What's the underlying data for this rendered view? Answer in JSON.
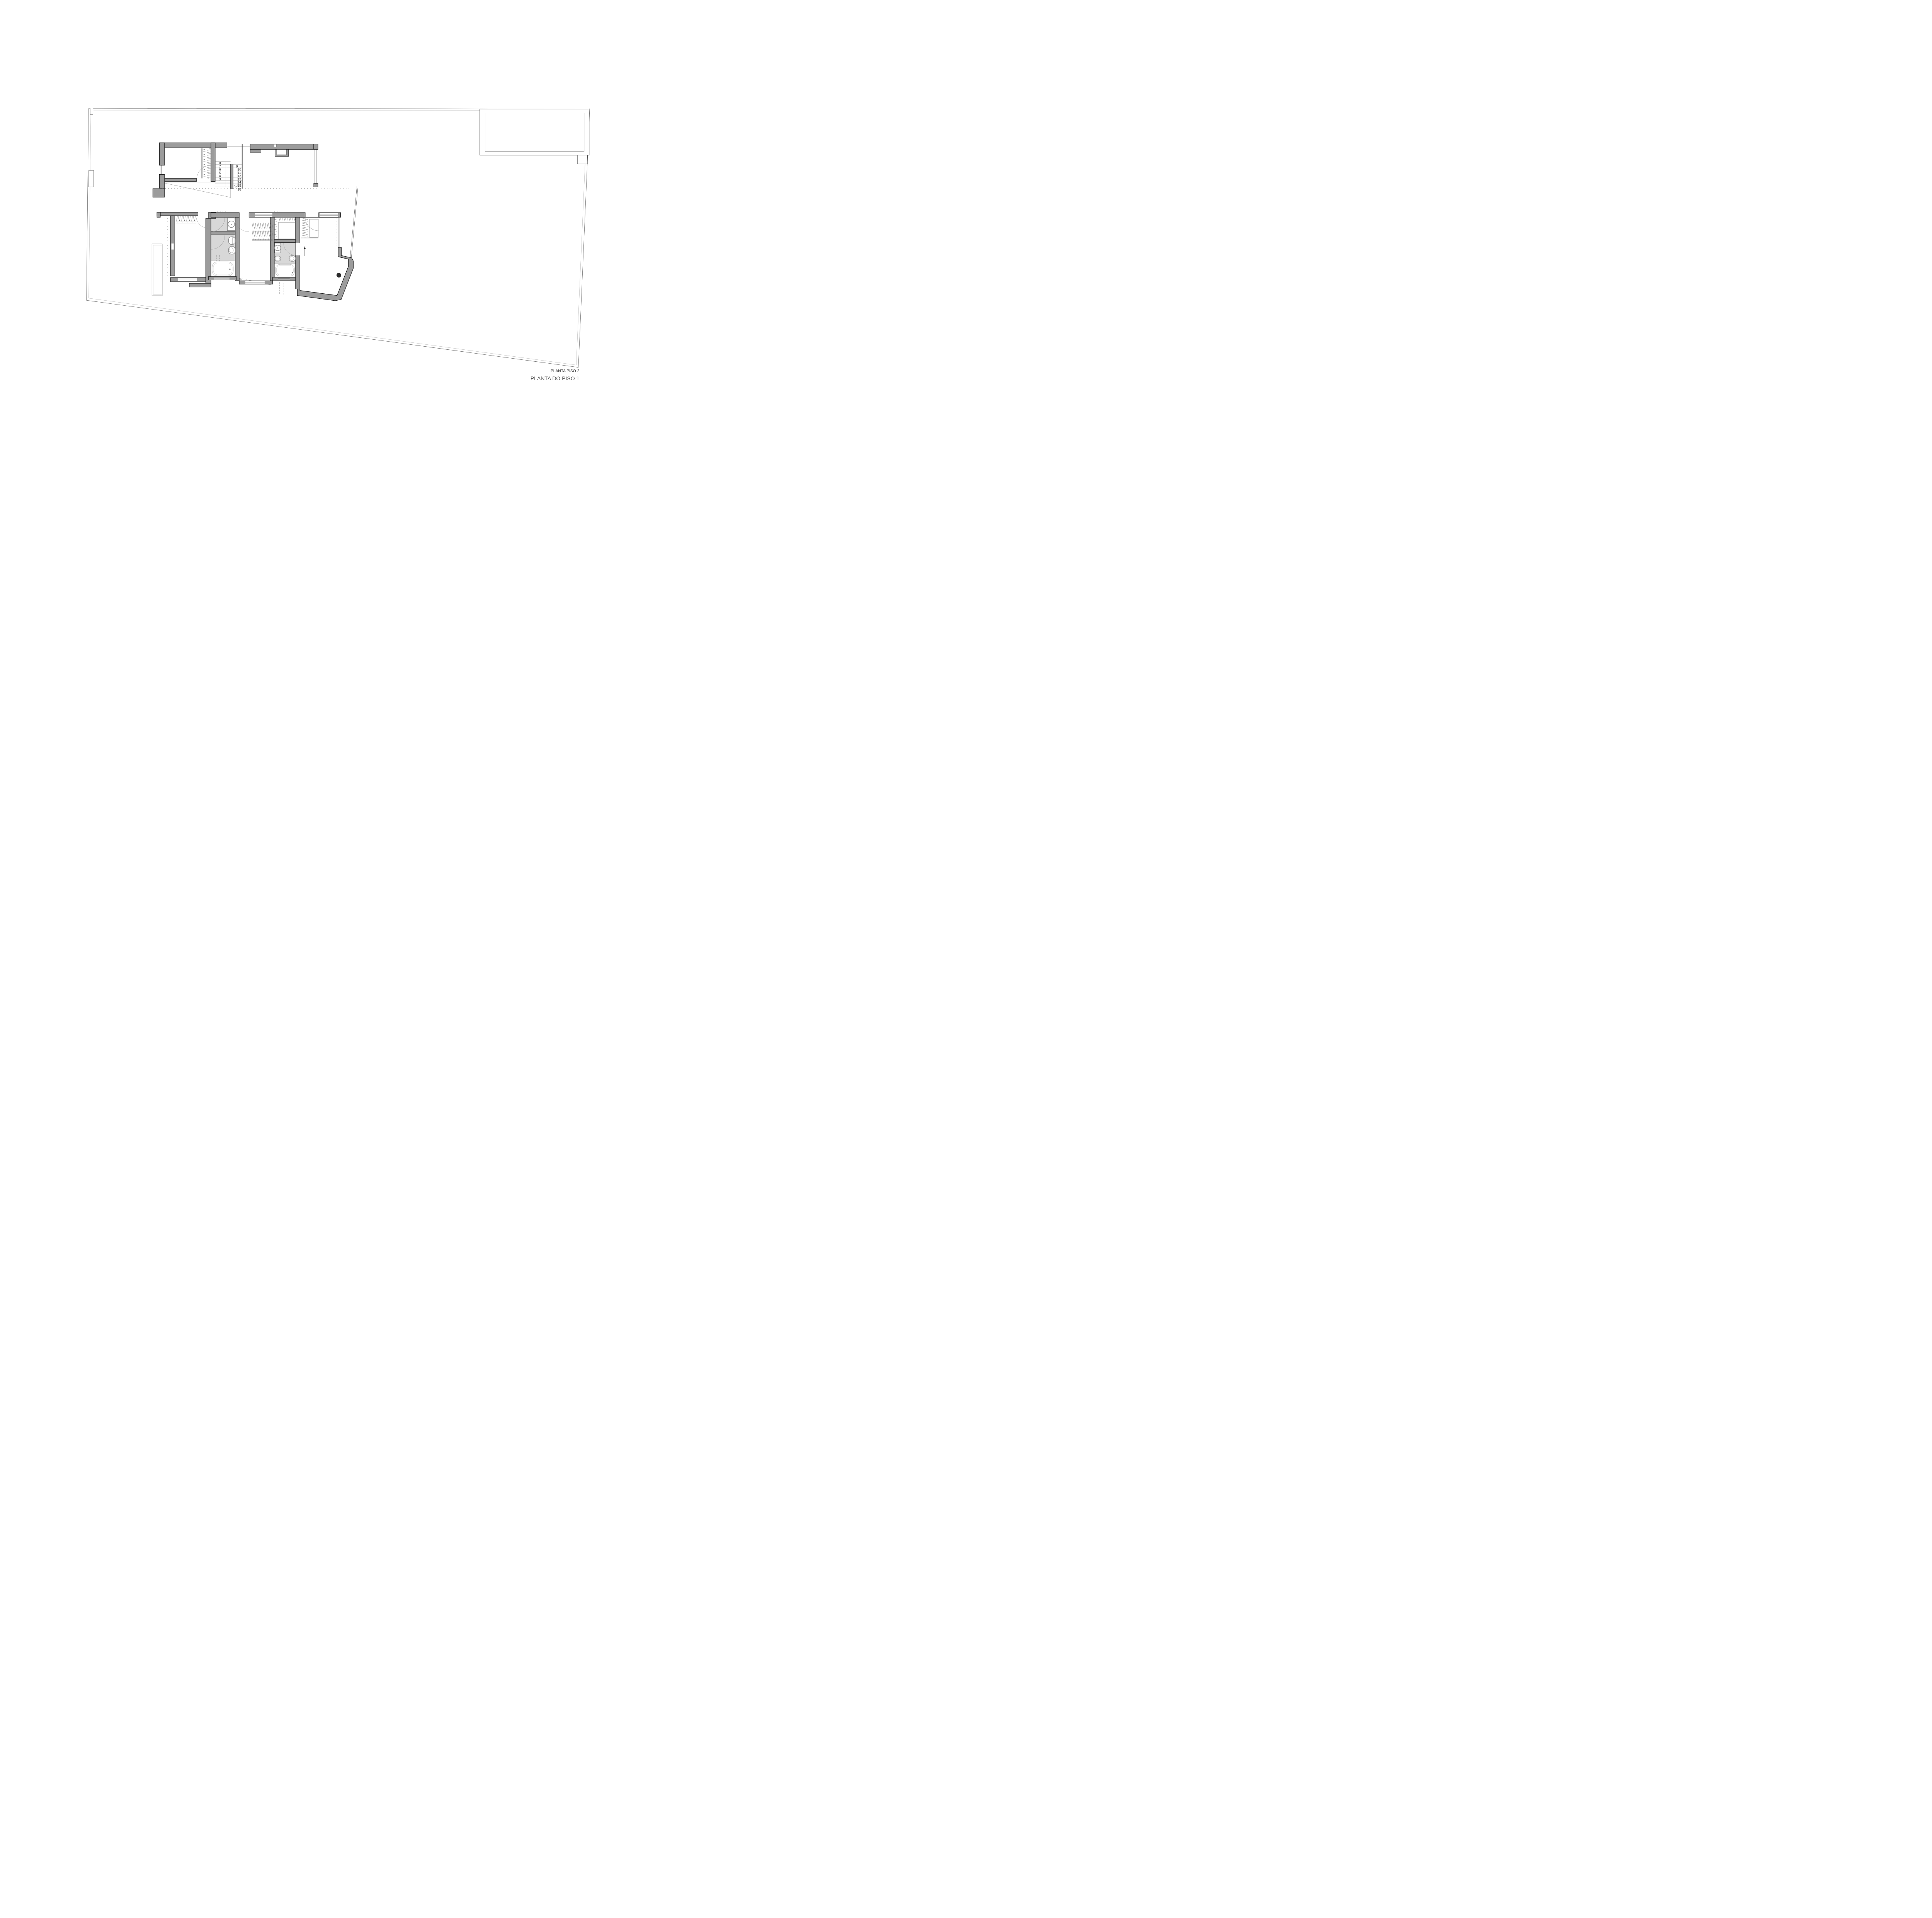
{
  "titles": {
    "plan_level_2": "PLANTA PISO 2",
    "plan_level_1": "PLANTA DO PISO 1"
  },
  "stair": {
    "left_numbers": [
      "8",
      "7",
      "6",
      "5",
      "4",
      "3"
    ],
    "right_numbers": [
      "9",
      "10",
      "11",
      "12",
      "13",
      "14",
      "15",
      "16"
    ]
  },
  "colors": {
    "paper": "#ffffff",
    "wall_fill": "#9c9c9c",
    "wall_edge": "#161616",
    "bathroom_floor": "#d8d8d8",
    "boundary_line": "#4a4a4a",
    "boundary_inner_line": "#9a9a9a",
    "fixture_line": "#8a8a8a",
    "label_dark": "#2e2e2e",
    "label_light": "#4e4e4e"
  }
}
